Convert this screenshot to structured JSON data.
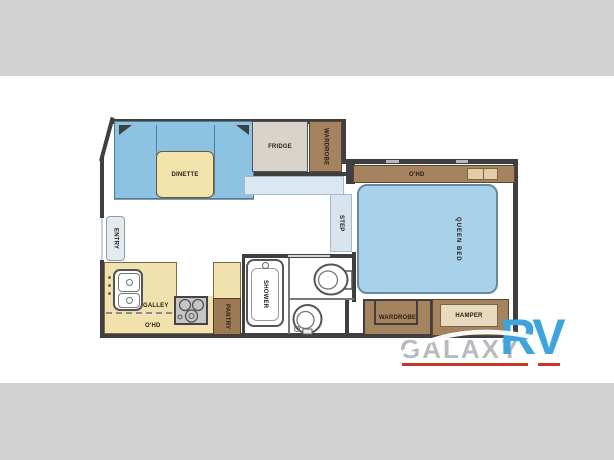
{
  "bars": {
    "top_color": "#d2d2d2",
    "bottom_color": "#d2d2d2"
  },
  "floorplan": {
    "labels": {
      "dinette": "DINETTE",
      "fridge": "FRIDGE",
      "wardrobe_top": "WARDROBE",
      "entry": "ENTRY",
      "step": "STEP",
      "galley": "GALLEY",
      "galley_ohd": "O'HD",
      "pantry": "PANTRY",
      "shower": "SHOWER",
      "bedroom_ohd": "O'HD",
      "queen_bed": "QUEEN BED",
      "wardrobe_bottom": "WARDROBE",
      "hamper": "HAMPER"
    },
    "colors": {
      "wall": "#3f3f3f",
      "bench_blue": "#8cc3e3",
      "bed_blue": "#a7d2e9",
      "hall_blue": "#dce8f1",
      "counter_cream": "#f0e1ad",
      "table_cream": "#f2e2ac",
      "cabinet_brown": "#a5835f",
      "inset_tan": "#e9d9bd",
      "fridge_gray": "#d8d4cc",
      "stove_gray": "#c6c6c6"
    }
  },
  "logo": {
    "brand_primary": "GALAXY",
    "brand_secondary": "RV",
    "colors": {
      "primary_text": "#a5aab0",
      "secondary_text": "#3ea4de",
      "underline": "#c8352b"
    }
  }
}
